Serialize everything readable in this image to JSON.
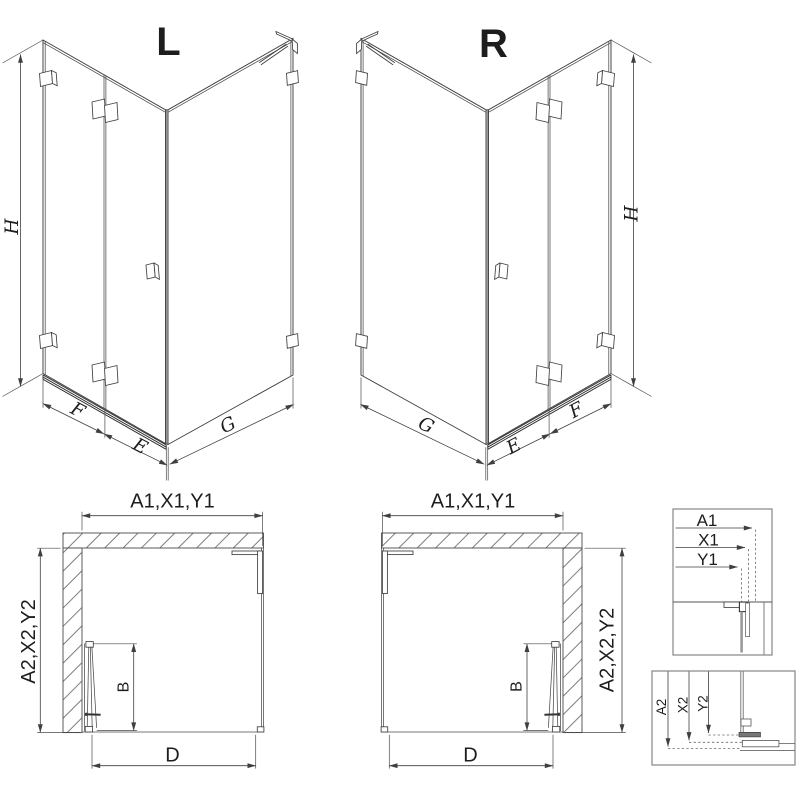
{
  "drawing": {
    "iso_left": {
      "label": "L",
      "height_dim": "H",
      "fixed_dim": "F",
      "door_dim": "E",
      "side_dim": "G"
    },
    "iso_right": {
      "label": "R",
      "height_dim": "H",
      "fixed_dim": "F",
      "door_dim": "E",
      "side_dim": "G"
    },
    "plan_left": {
      "width_dim": "A1,X1,Y1",
      "depth_dim": "A2,X2,Y2",
      "door_width_dim": "B",
      "opening_dim": "D"
    },
    "plan_right": {
      "width_dim": "A1,X1,Y1",
      "depth_dim": "A2,X2,Y2",
      "door_width_dim": "B",
      "opening_dim": "D"
    },
    "detail_width_box": {
      "labels": [
        "A1",
        "X1",
        "Y1"
      ]
    },
    "detail_depth_box": {
      "labels": [
        "A2",
        "X2",
        "Y2"
      ]
    }
  },
  "colors": {
    "line": "#3f3f3f",
    "text": "#1d1d1d",
    "detail_border": "#8f8f8f",
    "glass_gray": "#9a9a9a",
    "background": "#ffffff"
  }
}
